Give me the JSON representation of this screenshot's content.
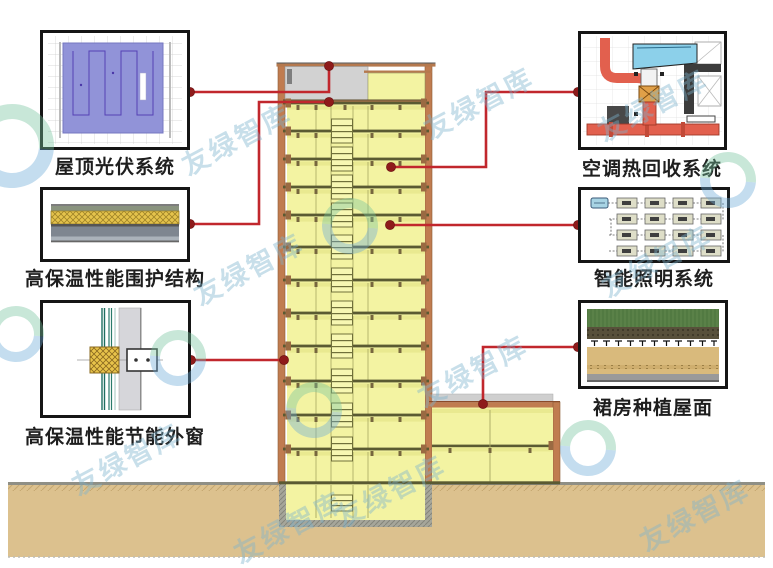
{
  "systems": [
    {
      "id": "pv",
      "label": "屋顶光伏系统"
    },
    {
      "id": "envelope",
      "label": "高保温性能围护结构"
    },
    {
      "id": "window",
      "label": "高保温性能节能外窗"
    },
    {
      "id": "hvac",
      "label": "空调热回收系统"
    },
    {
      "id": "lighting",
      "label": "智能照明系统"
    },
    {
      "id": "green_roof",
      "label": "裙房种植屋面"
    }
  ],
  "watermark": {
    "text": "友绿智库"
  },
  "colors": {
    "callout_line": "#c1272d",
    "callout_dot": "#8e1b1b",
    "floor_fill": "#f3f3a2",
    "floor_band": "#e9e990",
    "slab_line": "#5a5a32",
    "wall_orange": "#c07c50",
    "ground_tan": "#dcc18e",
    "roof_gray": "#d2d2d2",
    "pv_panel": "#9193d8",
    "insulation_yellow": "#e5c34c",
    "hvac_duct": "#e2604e",
    "hvac_unit": "#8cd0ea",
    "green_roof_green": "#5a8148"
  }
}
